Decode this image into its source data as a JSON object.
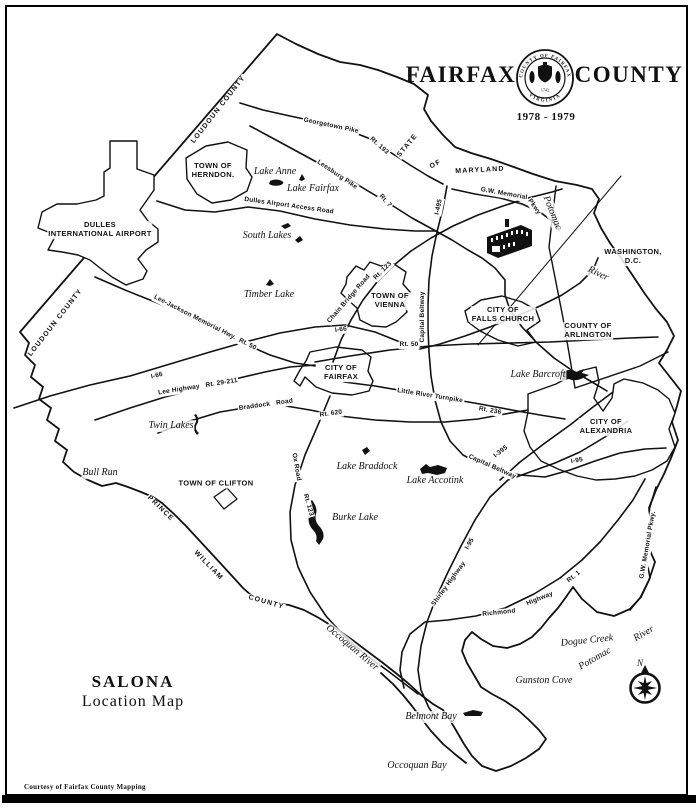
{
  "title": {
    "word_left": "FAIRFAX",
    "word_right": "COUNTY",
    "years": "1978 - 1979",
    "seal": {
      "ring_top": "COUNTY OF FAIRFAX",
      "ring_bottom": "VIRGINIA",
      "center_year": "1742"
    }
  },
  "map_title": {
    "name": "SALONA",
    "subtitle": "Location Map"
  },
  "credit": "Courtesy of Fairfax County Mapping",
  "compass": {
    "north_label": "N"
  },
  "colors": {
    "ink": "#111111",
    "paper": "#ffffff"
  },
  "icons": [
    "compass-rose-icon",
    "salona-house-icon",
    "county-seal-icon"
  ],
  "labels": [
    {
      "t": "TOWN OF\nHERNDON.",
      "x": 213,
      "y": 171,
      "c": "area"
    },
    {
      "t": "DULLES\nINTERNATIONAL AIRPORT",
      "x": 100,
      "y": 230,
      "c": "area"
    },
    {
      "t": "TOWN OF\nVIENNA",
      "x": 390,
      "y": 301,
      "c": "area"
    },
    {
      "t": "CITY OF\nFALLS CHURCH",
      "x": 503,
      "y": 315,
      "c": "area"
    },
    {
      "t": "COUNTY OF\nARLINGTON",
      "x": 588,
      "y": 331,
      "c": "area"
    },
    {
      "t": "WASHINGTON, D.C.",
      "x": 633,
      "y": 257,
      "c": "area"
    },
    {
      "t": "CITY OF\nFAIRFAX",
      "x": 341,
      "y": 373,
      "c": "area"
    },
    {
      "t": "CITY OF\nALEXANDRIA",
      "x": 606,
      "y": 427,
      "c": "area"
    },
    {
      "t": "TOWN OF CLIFTON",
      "x": 216,
      "y": 484,
      "c": "area"
    },
    {
      "t": "LOUDOUN COUNTY",
      "x": 219,
      "y": 110,
      "r": -52,
      "c": "border"
    },
    {
      "t": "LOUDOUN COUNTY",
      "x": 56,
      "y": 323,
      "r": -52,
      "c": "border"
    },
    {
      "t": "STATE",
      "x": 408,
      "y": 146,
      "r": -50,
      "c": "border"
    },
    {
      "t": "OF",
      "x": 436,
      "y": 165,
      "r": -28,
      "c": "border"
    },
    {
      "t": "MARYLAND",
      "x": 480,
      "y": 171,
      "r": -3,
      "c": "border"
    },
    {
      "t": "PRINCE",
      "x": 160,
      "y": 509,
      "r": 44,
      "c": "border"
    },
    {
      "t": "WILLIAM",
      "x": 208,
      "y": 566,
      "r": 46,
      "c": "border"
    },
    {
      "t": "COUNTY",
      "x": 266,
      "y": 603,
      "r": 16,
      "c": "border"
    },
    {
      "t": "Lake Anne",
      "x": 275,
      "y": 172,
      "c": "water"
    },
    {
      "t": "Lake Fairfax",
      "x": 313,
      "y": 189,
      "c": "water"
    },
    {
      "t": "South Lakes",
      "x": 267,
      "y": 236,
      "c": "water"
    },
    {
      "t": "Timber Lake",
      "x": 269,
      "y": 295,
      "c": "water"
    },
    {
      "t": "Lake Barcroft",
      "x": 538,
      "y": 375,
      "c": "water"
    },
    {
      "t": "Twin L​akes",
      "x": 171,
      "y": 426,
      "c": "water"
    },
    {
      "t": "Lake Braddock",
      "x": 367,
      "y": 467,
      "c": "water"
    },
    {
      "t": "Lake Accotink",
      "x": 435,
      "y": 481,
      "c": "water"
    },
    {
      "t": "Burke Lake",
      "x": 355,
      "y": 518,
      "c": "water"
    },
    {
      "t": "Bull Run",
      "x": 100,
      "y": 473,
      "c": "water"
    },
    {
      "t": "Occoquan River",
      "x": 352,
      "y": 648,
      "r": 40,
      "c": "water"
    },
    {
      "t": "Potomac",
      "x": 552,
      "y": 213,
      "r": 68,
      "c": "water"
    },
    {
      "t": "River",
      "x": 598,
      "y": 274,
      "r": 26,
      "c": "water"
    },
    {
      "t": "Potomac",
      "x": 595,
      "y": 659,
      "r": -30,
      "c": "water"
    },
    {
      "t": "River",
      "x": 644,
      "y": 634,
      "r": -30,
      "c": "water"
    },
    {
      "t": "Dogue Creek",
      "x": 587,
      "y": 641,
      "r": -6,
      "c": "water"
    },
    {
      "t": "Gunston Cove",
      "x": 544,
      "y": 681,
      "c": "water"
    },
    {
      "t": "Belmont Bay",
      "x": 431,
      "y": 717,
      "c": "water"
    },
    {
      "t": "Occoquan Bay",
      "x": 417,
      "y": 766,
      "c": "water"
    },
    {
      "t": "Georgetown Pike",
      "x": 331,
      "y": 126,
      "r": 12,
      "c": "road"
    },
    {
      "t": "Rt. 193",
      "x": 379,
      "y": 146,
      "r": 42,
      "c": "road"
    },
    {
      "t": "Leesburg Pike",
      "x": 337,
      "y": 175,
      "r": 34,
      "c": "road"
    },
    {
      "t": "Rt. 7",
      "x": 385,
      "y": 201,
      "r": 48,
      "c": "road"
    },
    {
      "t": "Dulles Airport Access Road",
      "x": 289,
      "y": 206,
      "r": 8,
      "c": "road"
    },
    {
      "t": "Lee-Jackson Memorial Hwy.  Rt. 50",
      "x": 205,
      "y": 323,
      "r": 27,
      "c": "road"
    },
    {
      "t": "I-66",
      "x": 341,
      "y": 330,
      "r": -8,
      "c": "road"
    },
    {
      "t": "I-66",
      "x": 157,
      "y": 376,
      "r": -14,
      "c": "road"
    },
    {
      "t": "Rt. 50",
      "x": 409,
      "y": 345,
      "c": "road"
    },
    {
      "t": "Lee Highway   Rt. 29-211",
      "x": 198,
      "y": 387,
      "r": -9,
      "c": "road"
    },
    {
      "t": "Braddock   Road",
      "x": 266,
      "y": 405,
      "r": -8,
      "c": "road"
    },
    {
      "t": "Rt. 620",
      "x": 331,
      "y": 414,
      "r": -8,
      "c": "road"
    },
    {
      "t": "Chain Bridge Road",
      "x": 349,
      "y": 299,
      "r": -49,
      "c": "road"
    },
    {
      "t": "Rt. 123",
      "x": 383,
      "y": 271,
      "r": -45,
      "c": "road"
    },
    {
      "t": "Capital Beltway",
      "x": 423,
      "y": 317,
      "r": -90,
      "c": "road"
    },
    {
      "t": "I-495",
      "x": 439,
      "y": 207,
      "r": -78,
      "c": "road"
    },
    {
      "t": "Little River Turnpike",
      "x": 430,
      "y": 396,
      "r": 9,
      "c": "road"
    },
    {
      "t": "Rt. 236",
      "x": 490,
      "y": 411,
      "r": 10,
      "c": "road"
    },
    {
      "t": "Ox Road",
      "x": 296,
      "y": 467,
      "r": 80,
      "c": "road"
    },
    {
      "t": "Rt. 123",
      "x": 308,
      "y": 505,
      "r": 74,
      "c": "road"
    },
    {
      "t": "Capital Beltway",
      "x": 492,
      "y": 467,
      "r": 24,
      "c": "road"
    },
    {
      "t": "I-395",
      "x": 501,
      "y": 452,
      "r": -38,
      "c": "road"
    },
    {
      "t": "I-95",
      "x": 470,
      "y": 544,
      "r": -60,
      "c": "road"
    },
    {
      "t": "I-95",
      "x": 577,
      "y": 461,
      "r": -10,
      "c": "road"
    },
    {
      "t": "Shirley Highway",
      "x": 449,
      "y": 584,
      "r": -54,
      "c": "road"
    },
    {
      "t": "Richmond",
      "x": 499,
      "y": 613,
      "r": -6,
      "c": "road"
    },
    {
      "t": "Highway",
      "x": 540,
      "y": 599,
      "r": -22,
      "c": "road"
    },
    {
      "t": "Rt. 1",
      "x": 574,
      "y": 577,
      "r": -38,
      "c": "road"
    },
    {
      "t": "G.W. Memorial",
      "x": 504,
      "y": 194,
      "r": 10,
      "c": "road"
    },
    {
      "t": "Pkwy",
      "x": 534,
      "y": 207,
      "r": 55,
      "c": "road"
    },
    {
      "t": "G.W. Memorial Pkwy.",
      "x": 648,
      "y": 545,
      "r": -80,
      "c": "road"
    }
  ]
}
